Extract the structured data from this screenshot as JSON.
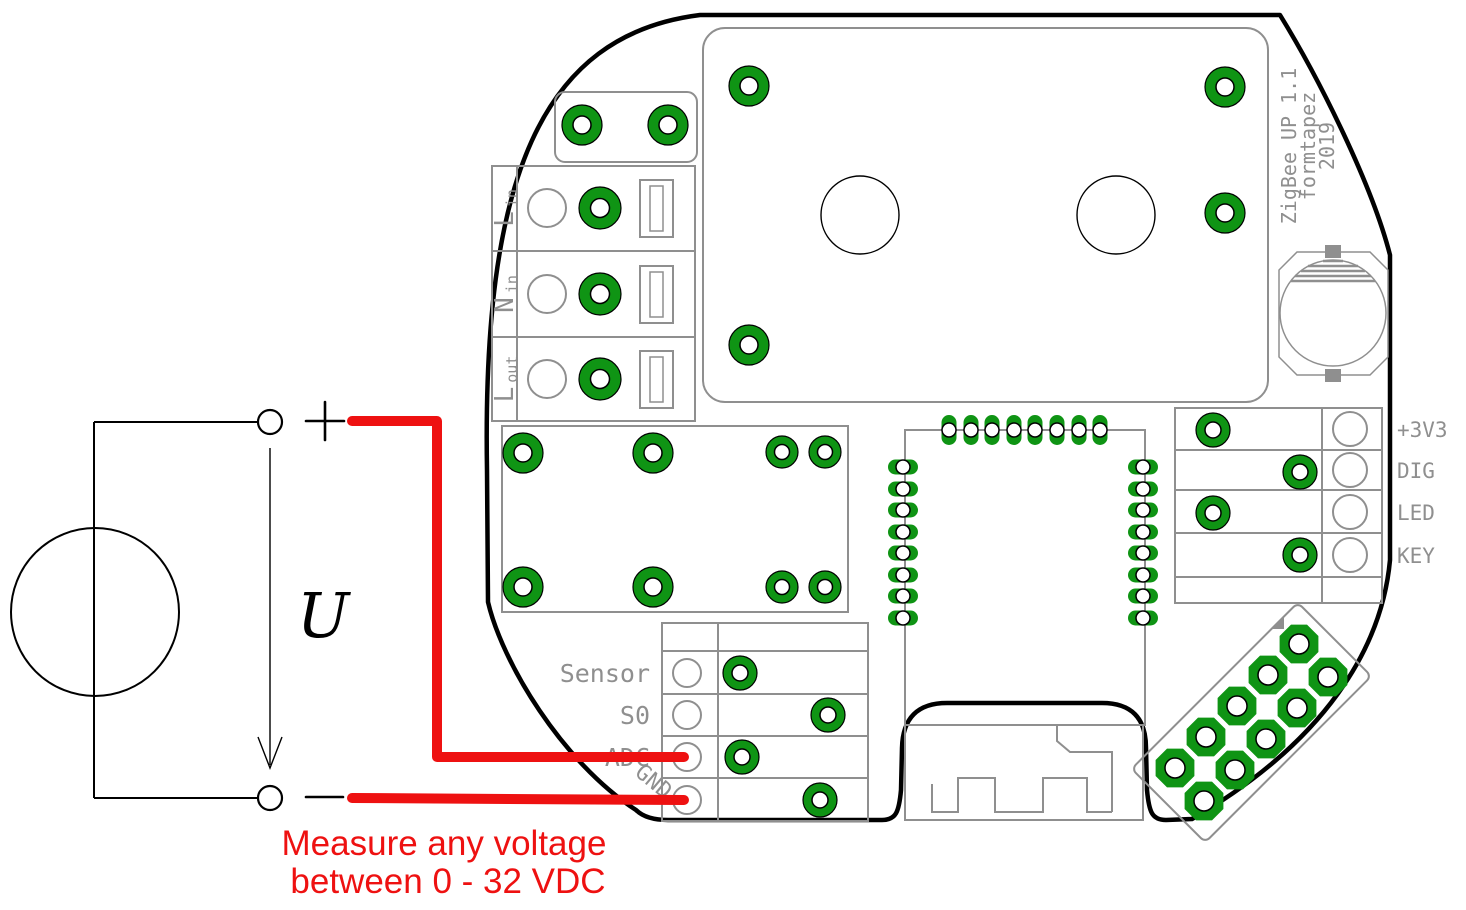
{
  "board": {
    "silkscreen_title": {
      "line1": "ZigBee UP 1.1",
      "line2": "formtapez",
      "line3": "2019"
    },
    "mains_terminals": {
      "rows": [
        {
          "label": "L",
          "sub": "in"
        },
        {
          "label": "N",
          "sub": "in"
        },
        {
          "label": "L",
          "sub": "out"
        }
      ]
    },
    "io_header": {
      "rows": [
        {
          "label": "Sensor"
        },
        {
          "label": "S0"
        },
        {
          "label": "ADC"
        },
        {
          "label": "GND"
        }
      ]
    },
    "signal_header": {
      "rows": [
        {
          "label": "+3V3"
        },
        {
          "label": "DIG"
        },
        {
          "label": "LED"
        },
        {
          "label": "KEY"
        }
      ]
    }
  },
  "circuit": {
    "voltage_label": "U",
    "plus_sign": "+",
    "minus_sign": "-"
  },
  "annotation": {
    "line1": "Measure any voltage",
    "line2": "between 0 - 32 VDC"
  },
  "colors": {
    "pad_green": "#0f9414",
    "silkscreen_gray": "#8f8f8f",
    "wire_red": "#ee1111",
    "board_outline": "#000000"
  }
}
